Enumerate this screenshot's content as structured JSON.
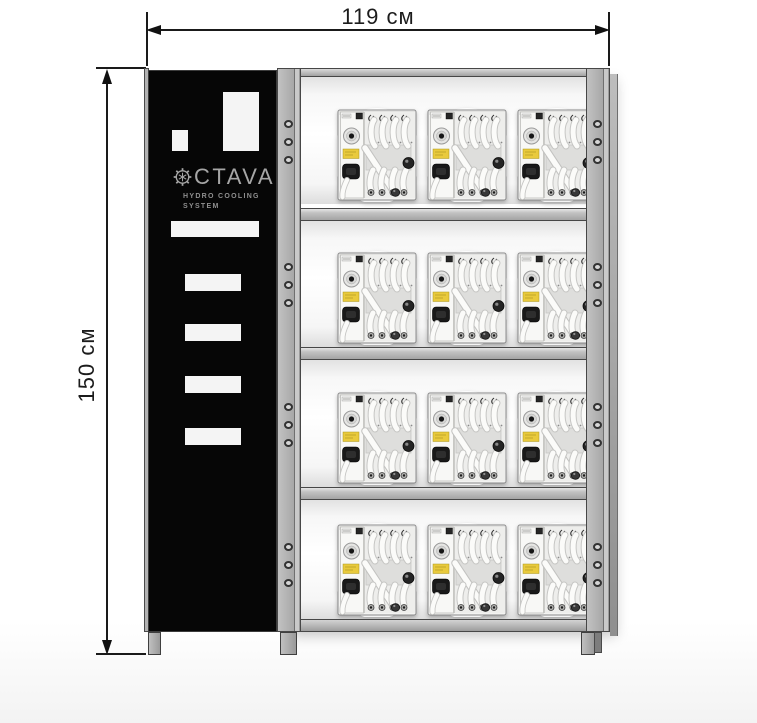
{
  "dimensions": {
    "width": "119 см",
    "height": "150 см"
  },
  "brand": {
    "logo_text": "CTAVA",
    "subtitle_line1": "HYDRO COOLING",
    "subtitle_line2": "SYSTEM"
  },
  "rack": {
    "rows": 4,
    "units_per_row": 3,
    "unit_count": 12,
    "holes_per_level": 3
  },
  "colors": {
    "panel_black": "#060606",
    "frame_gray": "#b2b2b2",
    "unit_label_yellow": "#e9ca3c",
    "dimension_line": "#1a1a1a",
    "logo_gray": "#a6a6a6"
  }
}
